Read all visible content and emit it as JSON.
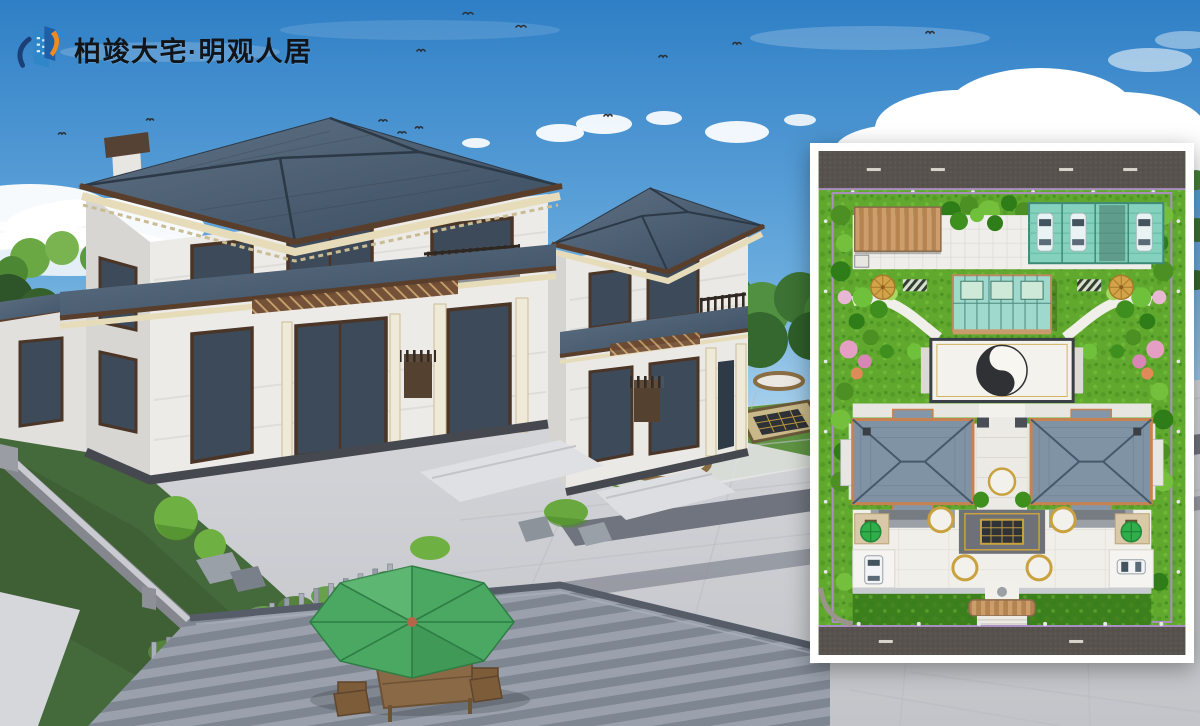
{
  "logo": {
    "text": "柏竣大宅·明观人居",
    "icon": "brand-building-icon"
  },
  "colors": {
    "brand_blue": "#1e5fa8",
    "brand_blue_light": "#2f86c8",
    "brand_orange": "#f08a1d",
    "brand_navy": "#1c3f77",
    "logo_text": "#111418",
    "sky_top": "#2f7fc6",
    "sky_mid": "#69abdd",
    "sky_horizon": "#cfe8f5",
    "cloud_white": "#ffffff",
    "roof_light": "#5f7184",
    "roof_dark": "#3a4c5f",
    "roof_fascia": "#5a3e2c",
    "cornice_cream": "#e7dcba",
    "wall_light": "#edebe7",
    "wall_shade": "#d8d6d2",
    "glass_dark": "#3d4a59",
    "pavement": "#cccdd2",
    "pavement_band_dark": "#70747e",
    "deck_light": "#9aa1ac",
    "deck_dark": "#7e8692",
    "lawn_green": "#5f9343",
    "garden_green": "#44693a",
    "hedge_bright": "#55833b",
    "tree_dark": "#2f5e29",
    "umbrella_green": "#4aa862",
    "wood_brown": "#8a6a46",
    "plan_frame_white": "#ffffff",
    "plan_road": "#57524e",
    "plan_green": "#61a92e",
    "plan_green_dark": "#3c7f1d",
    "plan_pavement": "#efeeea",
    "plan_carport_teal": "#84d2bd",
    "plan_canopy_tan": "#c3945f",
    "plan_roof": "#8093a5",
    "plan_trim_orange": "#c8824f",
    "plan_curb_purple": "#a98fc2",
    "plan_gold": "#c9a23f",
    "yinyang_dark": "#2f3134",
    "yinyang_light": "#f7f6f1",
    "plan_umbrella_green": "#2fae4a",
    "plan_umbrella_tan": "#d2a348",
    "flower_pink": "#e59ec4"
  }
}
